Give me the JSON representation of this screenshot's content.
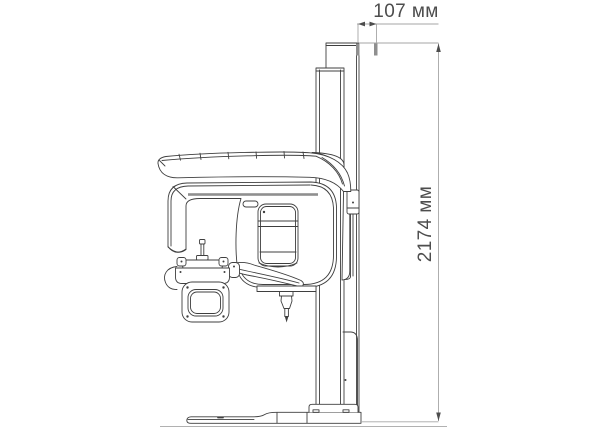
{
  "dimensions": {
    "width": {
      "label": "107 мм"
    },
    "height": {
      "label": "2174 мм"
    }
  },
  "colors": {
    "outline": "#3f3f3f",
    "dimension_line": "#a6a6a6",
    "dimension_text": "#4d4d4d",
    "shade": "#8f8f8f",
    "background": "#ffffff"
  }
}
